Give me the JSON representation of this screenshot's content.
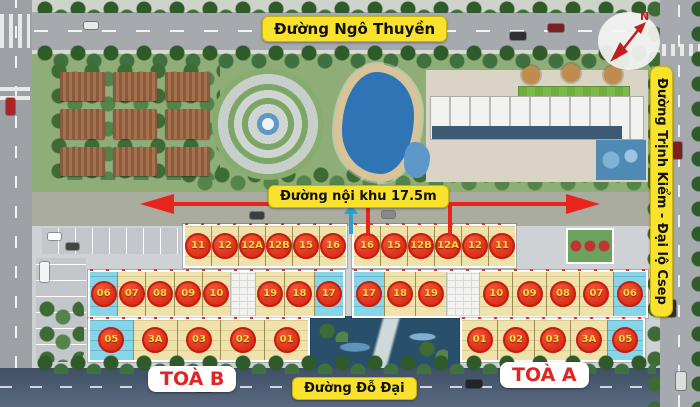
{
  "site": {
    "roads": {
      "top": "Đường Ngô Thuyền",
      "inner": "Đường nội khu 17.5m",
      "bottom": "Đường Đỗ Đại",
      "right": "Đường Trịnh Kiểm - Đại lộ Csep"
    },
    "compass_label": "N",
    "buildings": [
      {
        "short": "b",
        "name": "TOÀ B",
        "rows": {
          "top": [
            "11",
            "12",
            "12A",
            "12B",
            "15",
            "16"
          ],
          "mid_left": [
            "06",
            "07",
            "08",
            "09",
            "10"
          ],
          "mid_right": [
            "19",
            "18",
            "17"
          ],
          "bottom": [
            "05",
            "3A",
            "03",
            "02",
            "01"
          ]
        },
        "blue_units": [
          "05",
          "06",
          "17"
        ]
      },
      {
        "short": "a",
        "name": "TOÀ A",
        "rows": {
          "top": [
            "16",
            "15",
            "12B",
            "12A",
            "12",
            "11"
          ],
          "mid_left": [
            "17",
            "18",
            "19"
          ],
          "mid_right": [
            "10",
            "09",
            "08",
            "07",
            "06"
          ],
          "bottom": [
            "01",
            "02",
            "03",
            "3A",
            "05"
          ]
        },
        "blue_units": [
          "17",
          "06",
          "05"
        ]
      }
    ],
    "colors": {
      "label_bg": "#f9e22b",
      "unit_circle_red": "#dd2e18",
      "unit_number_yellow": "#ffd83d",
      "unit_fill_yellow": "#efe3ab",
      "unit_fill_blue": "#86d5e8",
      "arrow_red": "#e8241c",
      "tower_label_red": "#e02525"
    }
  }
}
